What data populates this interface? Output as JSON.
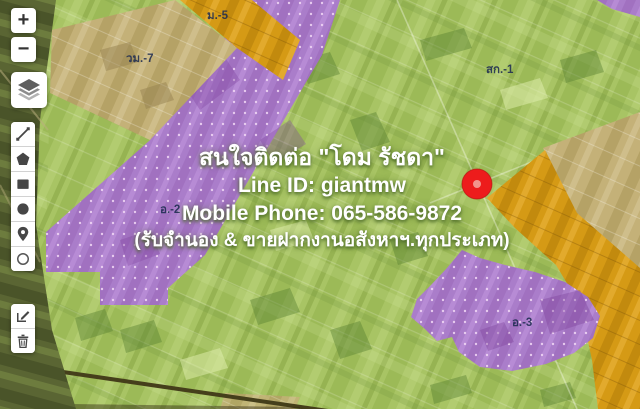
{
  "overlay": {
    "contact_line1": "สนใจติดต่อ \"โดม รัชดา\"",
    "contact_line2": "Line ID: giantmw",
    "contact_line3": "Mobile Phone: 065-586-9872",
    "contact_line4": "(รับจำนอง & ขายฝากงานอสังหาฯ.ทุกประเภท)"
  },
  "zone_labels": {
    "m5": "ม.-5",
    "wm7": "วม.-7",
    "sk1": "สก.-1",
    "o2": "อ.-2",
    "o3": "อ.-3"
  },
  "controls": {
    "zoom_in": "+",
    "zoom_out": "−",
    "icons": [
      "layers-icon",
      "polyline-icon",
      "polygon-icon",
      "rectangle-icon",
      "circle-icon",
      "marker-icon",
      "circle-marker-icon",
      "edit-icon",
      "trash-icon"
    ]
  },
  "marker": {
    "color": "#ed1c1c"
  },
  "zone_colors": {
    "agriculture_green": "#a8c464",
    "zoned_purple": "#aa7dca",
    "zoned_orange": "#d59a15",
    "unzoned_tan": "#c4b178"
  }
}
